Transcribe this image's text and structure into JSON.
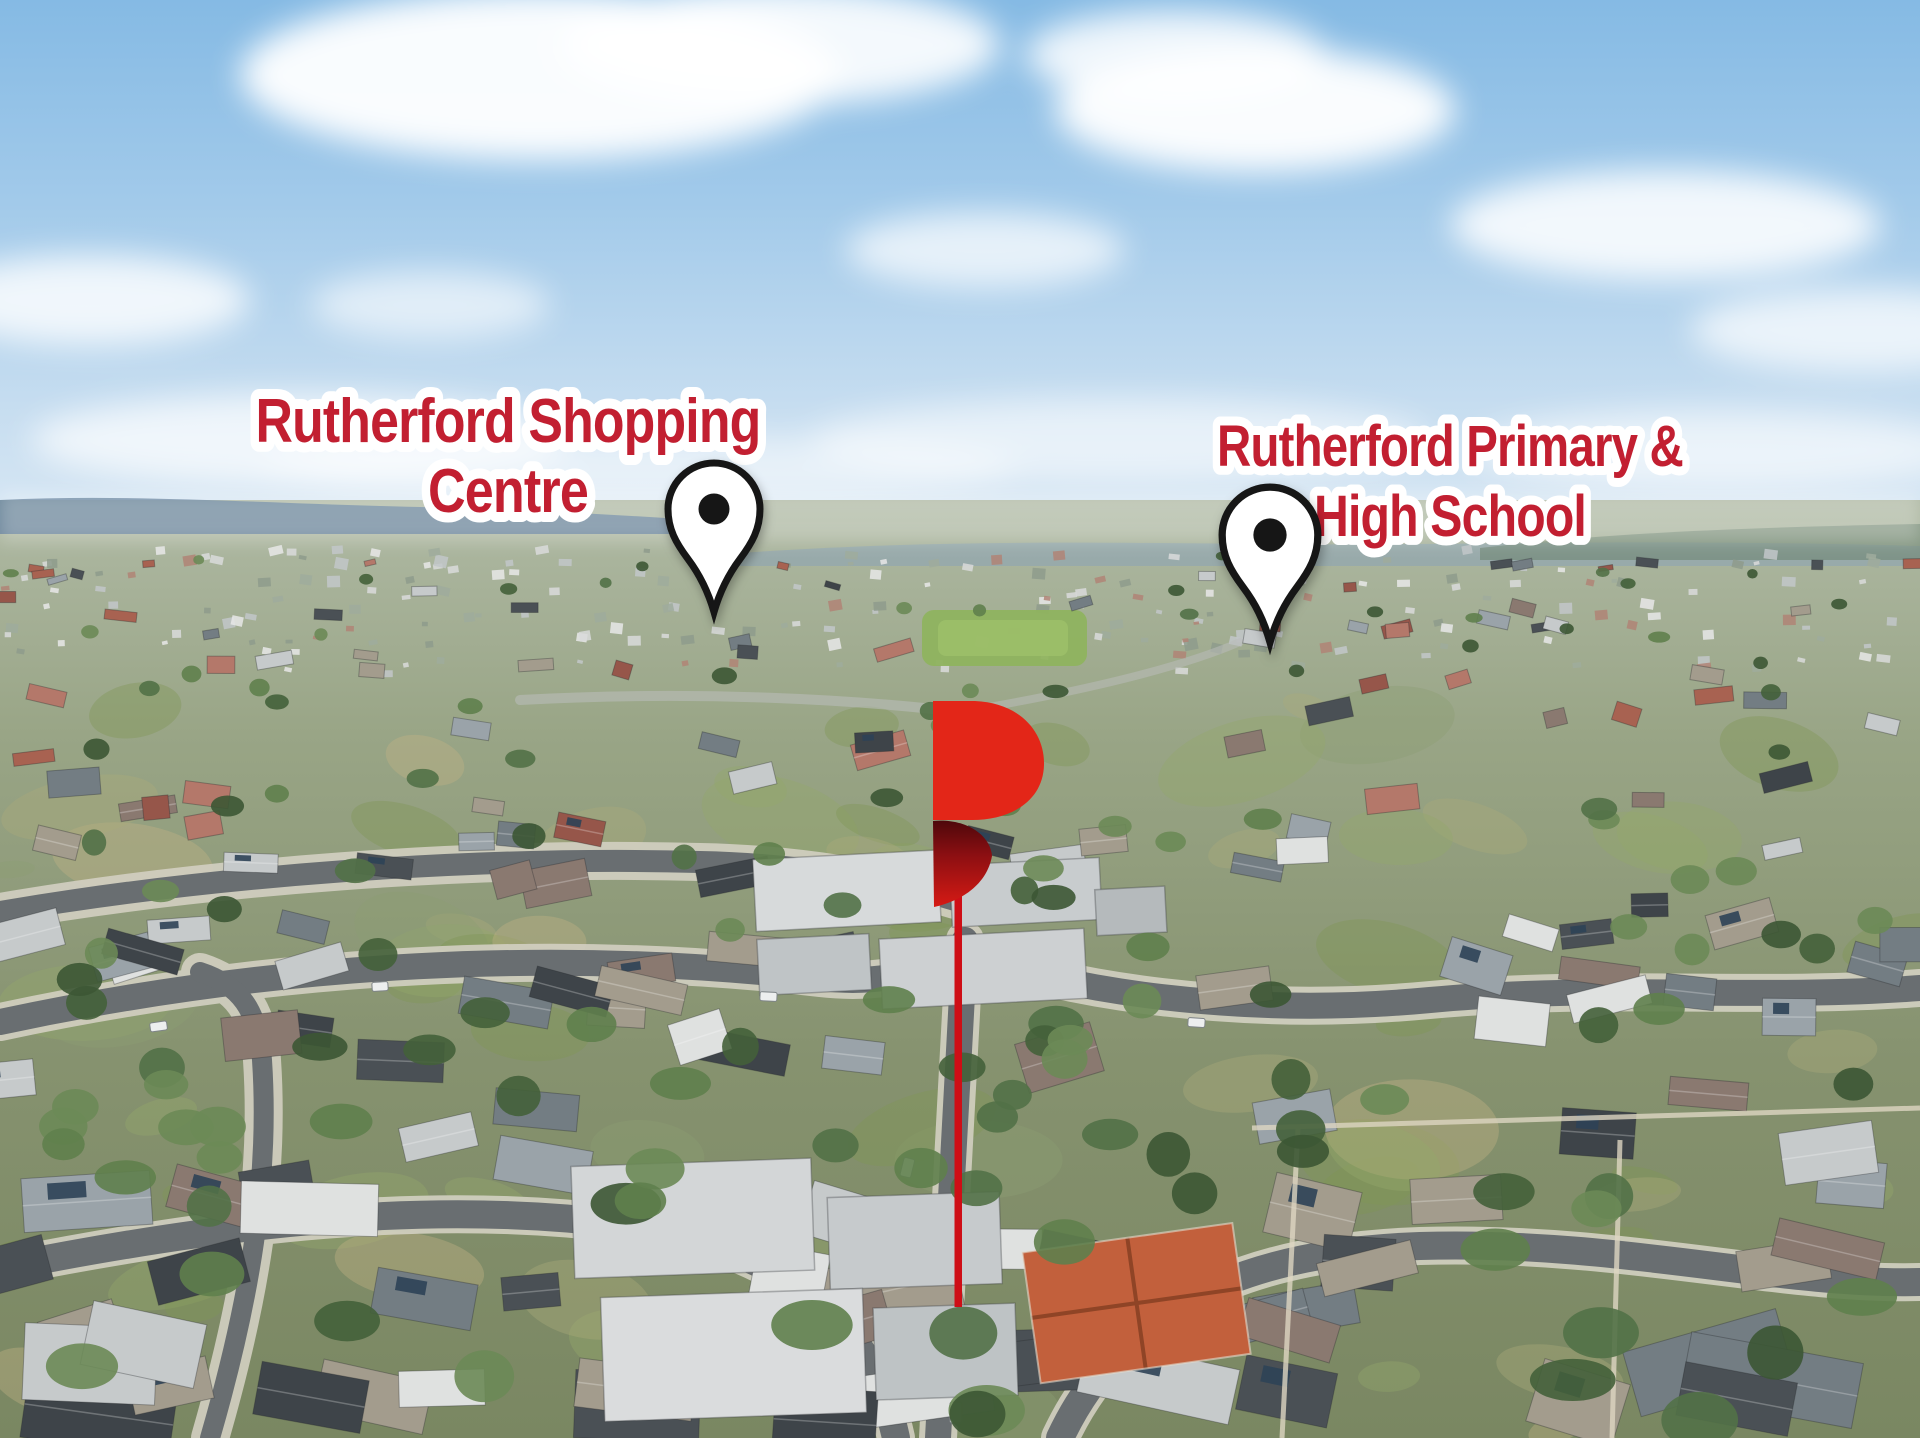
{
  "annotations": {
    "labels": [
      {
        "id": "shopping-centre",
        "lines": [
          "Rutherford Shopping",
          "Centre"
        ]
      },
      {
        "id": "school",
        "lines": [
          "Rutherford Primary &",
          "High School"
        ]
      }
    ],
    "markers": [
      {
        "name": "shopping-centre-pin",
        "icon": "map-pin-icon"
      },
      {
        "name": "school-pin",
        "icon": "map-pin-icon"
      },
      {
        "name": "property-marker",
        "icon": "brand-logo-p-icon"
      }
    ]
  },
  "colors": {
    "label_text": "#C21F31",
    "label_outline": "#FFFFFF",
    "pin_fill": "#FFFFFF",
    "pin_outline": "#151515",
    "pin_dot": "#151515",
    "logo_red": "#E32618",
    "logo_leaf_dark": "#4E080B",
    "marker_line": "#CE0E16"
  }
}
